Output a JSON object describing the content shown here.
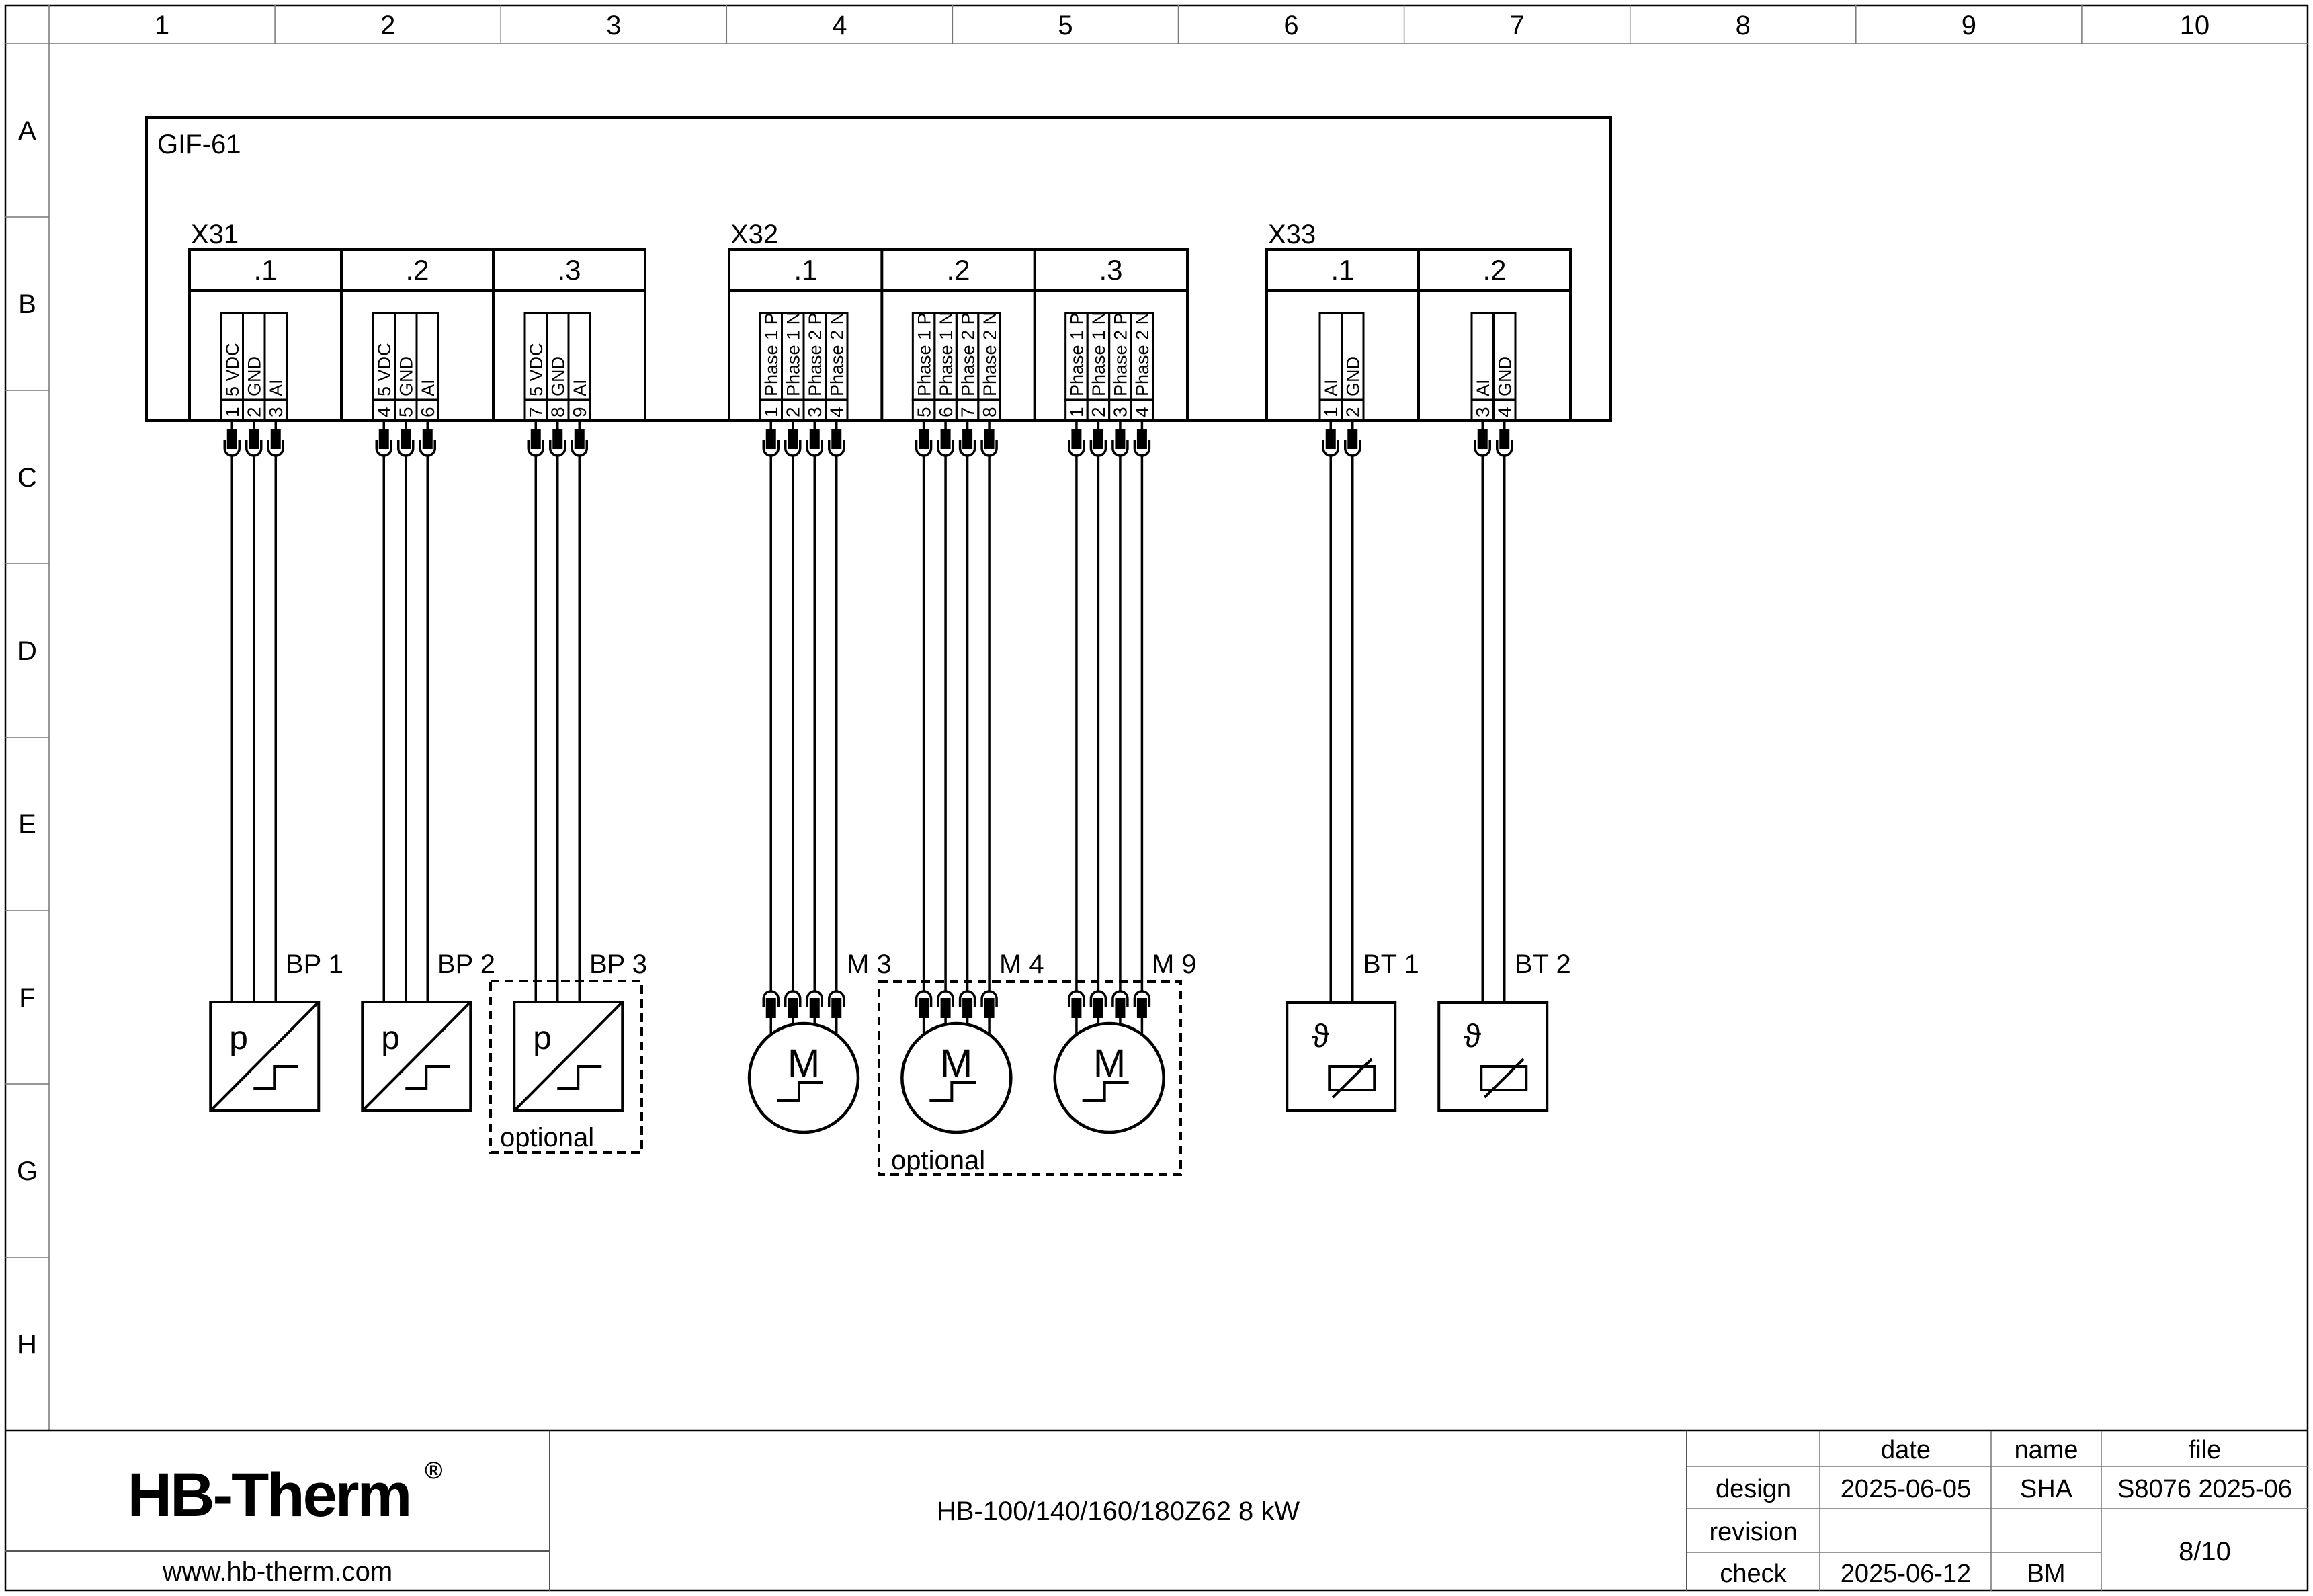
{
  "sheet": {
    "grid_columns": [
      "1",
      "2",
      "3",
      "4",
      "5",
      "6",
      "7",
      "8",
      "9",
      "10"
    ],
    "grid_rows": [
      "A",
      "B",
      "C",
      "D",
      "E",
      "F",
      "G",
      "H"
    ]
  },
  "diagram": {
    "enclosure_label": "GIF-61",
    "optional_label": "optional",
    "connectors": [
      {
        "name": "X31",
        "sections": [
          {
            "label": ".1",
            "pins": [
              {
                "no": "1",
                "signal": "5 VDC"
              },
              {
                "no": "2",
                "signal": "GND"
              },
              {
                "no": "3",
                "signal": "AI"
              }
            ]
          },
          {
            "label": ".2",
            "pins": [
              {
                "no": "4",
                "signal": "5 VDC"
              },
              {
                "no": "5",
                "signal": "GND"
              },
              {
                "no": "6",
                "signal": "AI"
              }
            ]
          },
          {
            "label": ".3",
            "pins": [
              {
                "no": "7",
                "signal": "5 VDC"
              },
              {
                "no": "8",
                "signal": "GND"
              },
              {
                "no": "9",
                "signal": "AI"
              }
            ]
          }
        ]
      },
      {
        "name": "X32",
        "sections": [
          {
            "label": ".1",
            "pins": [
              {
                "no": "1",
                "signal": "Phase 1 P"
              },
              {
                "no": "2",
                "signal": "Phase 1 N"
              },
              {
                "no": "3",
                "signal": "Phase 2 P"
              },
              {
                "no": "4",
                "signal": "Phase 2 N"
              }
            ]
          },
          {
            "label": ".2",
            "pins": [
              {
                "no": "5",
                "signal": "Phase 1 P"
              },
              {
                "no": "6",
                "signal": "Phase 1 N"
              },
              {
                "no": "7",
                "signal": "Phase 2 P"
              },
              {
                "no": "8",
                "signal": "Phase 2 N"
              }
            ]
          },
          {
            "label": ".3",
            "pins": [
              {
                "no": "1",
                "signal": "Phase 1 P"
              },
              {
                "no": "2",
                "signal": "Phase 1 N"
              },
              {
                "no": "3",
                "signal": "Phase 2 P"
              },
              {
                "no": "4",
                "signal": "Phase 2 N"
              }
            ]
          }
        ]
      },
      {
        "name": "X33",
        "sections": [
          {
            "label": ".1",
            "pins": [
              {
                "no": "1",
                "signal": "AI"
              },
              {
                "no": "2",
                "signal": "GND"
              }
            ]
          },
          {
            "label": ".2",
            "pins": [
              {
                "no": "3",
                "signal": "AI"
              },
              {
                "no": "4",
                "signal": "GND"
              }
            ]
          }
        ]
      }
    ],
    "devices": [
      {
        "label": "BP 1",
        "type": "pressure-sensor",
        "symbol_letter": "p"
      },
      {
        "label": "BP 2",
        "type": "pressure-sensor",
        "symbol_letter": "p"
      },
      {
        "label": "BP 3",
        "type": "pressure-sensor",
        "symbol_letter": "p"
      },
      {
        "label": "M 3",
        "type": "motor",
        "symbol_letter": "M"
      },
      {
        "label": "M 4",
        "type": "motor",
        "symbol_letter": "M"
      },
      {
        "label": "M 9",
        "type": "motor",
        "symbol_letter": "M"
      },
      {
        "label": "BT 1",
        "type": "temperature-sensor",
        "symbol_letter": "ϑ"
      },
      {
        "label": "BT 2",
        "type": "temperature-sensor",
        "symbol_letter": "ϑ"
      }
    ]
  },
  "title_block": {
    "logo_text": "HB-Therm",
    "logo_registered_mark": "®",
    "logo_color": "#1a2348",
    "website": "www.hb-therm.com",
    "drawing_title": "HB-100/140/160/180Z62 8 kW",
    "table": {
      "col_headers": [
        "date",
        "name",
        "file"
      ],
      "rows": [
        {
          "label": "design",
          "date": "2025-06-05",
          "name": "SHA",
          "file": "S8076 2025-06"
        },
        {
          "label": "revision",
          "date": "",
          "name": "",
          "file": ""
        },
        {
          "label": "check",
          "date": "2025-06-12",
          "name": "BM",
          "file": ""
        }
      ],
      "sheet_number": "8/10"
    }
  }
}
